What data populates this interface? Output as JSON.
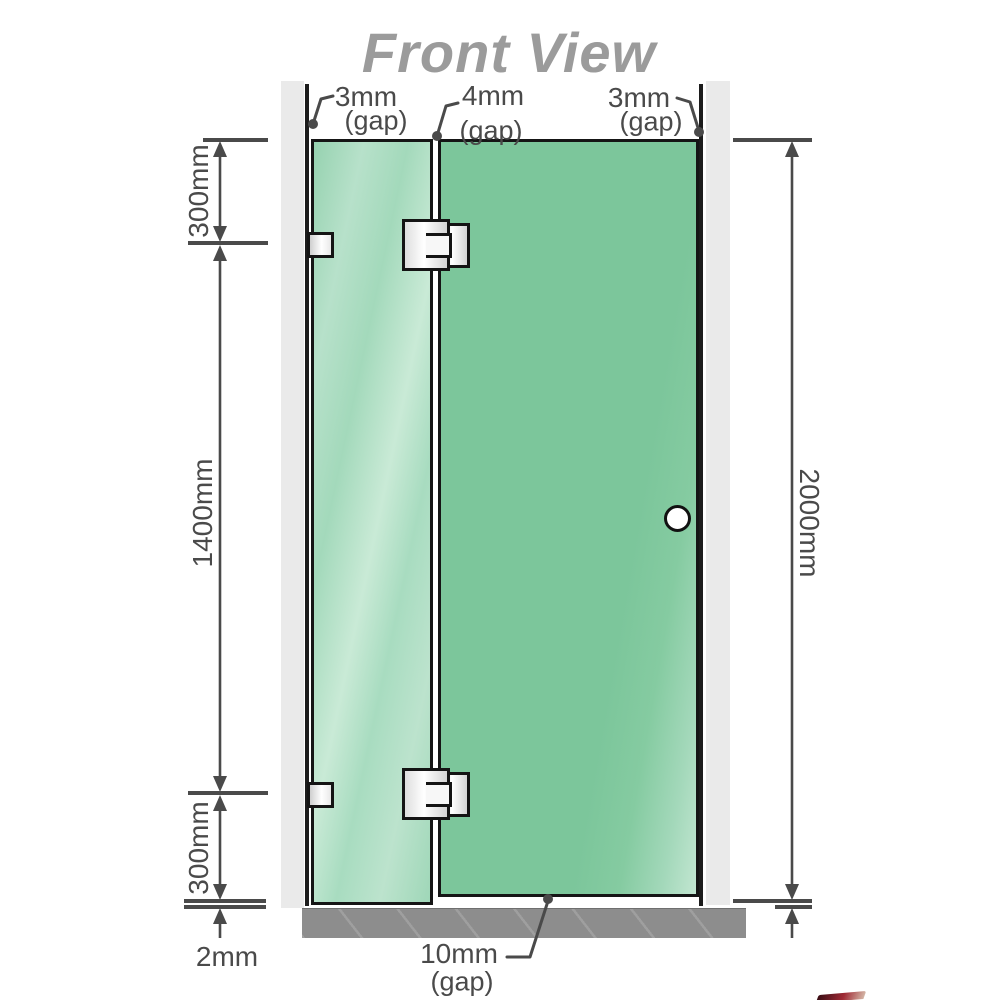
{
  "title": "Front View",
  "labels": {
    "gap_top_left": {
      "value": "3mm",
      "suffix": "(gap)"
    },
    "gap_top_middle": {
      "value": "4mm",
      "suffix": "(gap)"
    },
    "gap_top_right": {
      "value": "3mm",
      "suffix": "(gap)"
    },
    "gap_bottom": {
      "value": "10mm",
      "suffix": "(gap)"
    },
    "dim_top_left": "300mm",
    "dim_middle_left": "1400mm",
    "dim_bottom_left": "300mm",
    "dim_floor_gap": "2mm",
    "dim_overall_height": "2000mm"
  },
  "colors": {
    "title_text": "#9b9b9b",
    "dimension_text": "#4a4a4a",
    "dimension_line": "#4a4a4a",
    "glass_fixed_panel": "#a9dcc1",
    "glass_door_panel": "#7cc69b",
    "wall_channel": "#eaeaea",
    "floor": "#8d8d8d",
    "outline": "#151515",
    "hardware": "#f2f2f2"
  }
}
